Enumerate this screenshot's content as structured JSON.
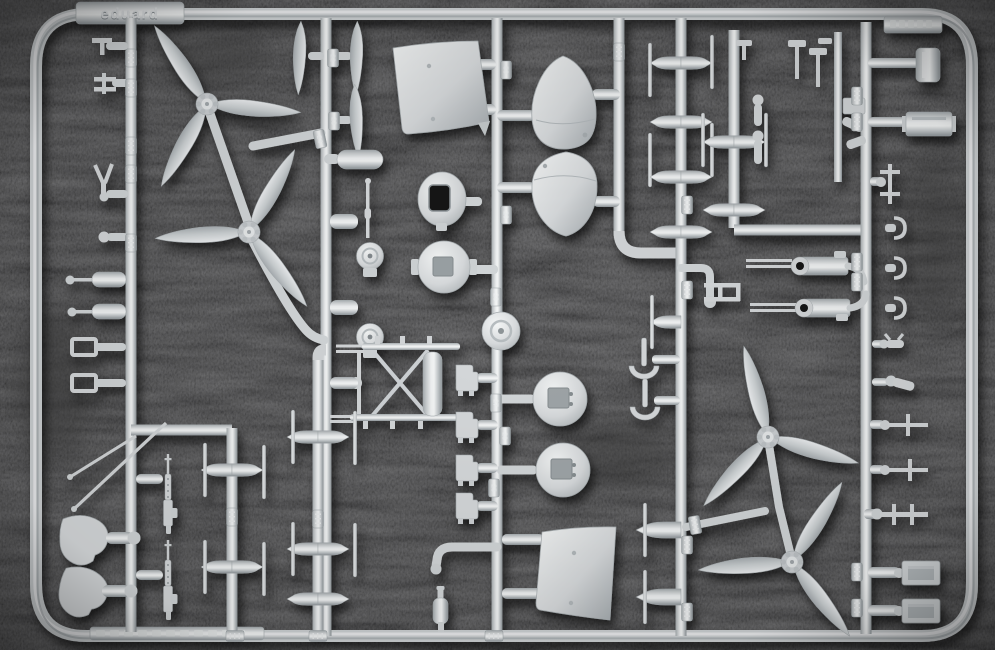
{
  "scene": {
    "type": "photograph",
    "subject": "Light grey injection-moulded plastic model aircraft sprue photographed on black chenille fabric",
    "plastic_color_hex": "#d6d9db",
    "plastic_highlight_hex": "#f2f4f5",
    "plastic_shadow_hex": "#9aa0a4",
    "background_color_hex": "#131313"
  },
  "tabs": {
    "top_left": {
      "text": "eduard"
    },
    "top_right": {
      "text_legible": false,
      "description": "small embossed code tab, illegible"
    },
    "bottom_left": {
      "text_legible": false,
      "description": "long embossed strip, illegible"
    }
  },
  "runner_tags": [
    {
      "label": "22"
    },
    {
      "label": "23"
    },
    {
      "label": "24"
    },
    {
      "label": "50"
    },
    {
      "label": "29"
    },
    {
      "label": "28"
    },
    {
      "label": "27"
    },
    {
      "label": "26"
    },
    {
      "label": "25"
    }
  ],
  "parts_inventory": [
    "three-blade propeller (x4)",
    "spare propeller blade (x3)",
    "engine cowling side panel (x2)",
    "engine nacelle / cowling half (x2)",
    "cowling front ring with rectangular opening (x3)",
    "oval intake ring",
    "wheel disc (x3)",
    "wheel spat (x2)",
    "machine gun with perforated jacket (x2)",
    "gun with drum magazine (x2)",
    "exhaust stack spindles (many)",
    "radiator box (x4)",
    "cockpit bracket / seat (x4)",
    "tail-wheel yoke (x2)",
    "landing-gear strut assembly",
    "antenna mast (x2)",
    "curved exhaust pipe",
    "small bottle / reservoir",
    "assorted rods, struts and fittings"
  ]
}
